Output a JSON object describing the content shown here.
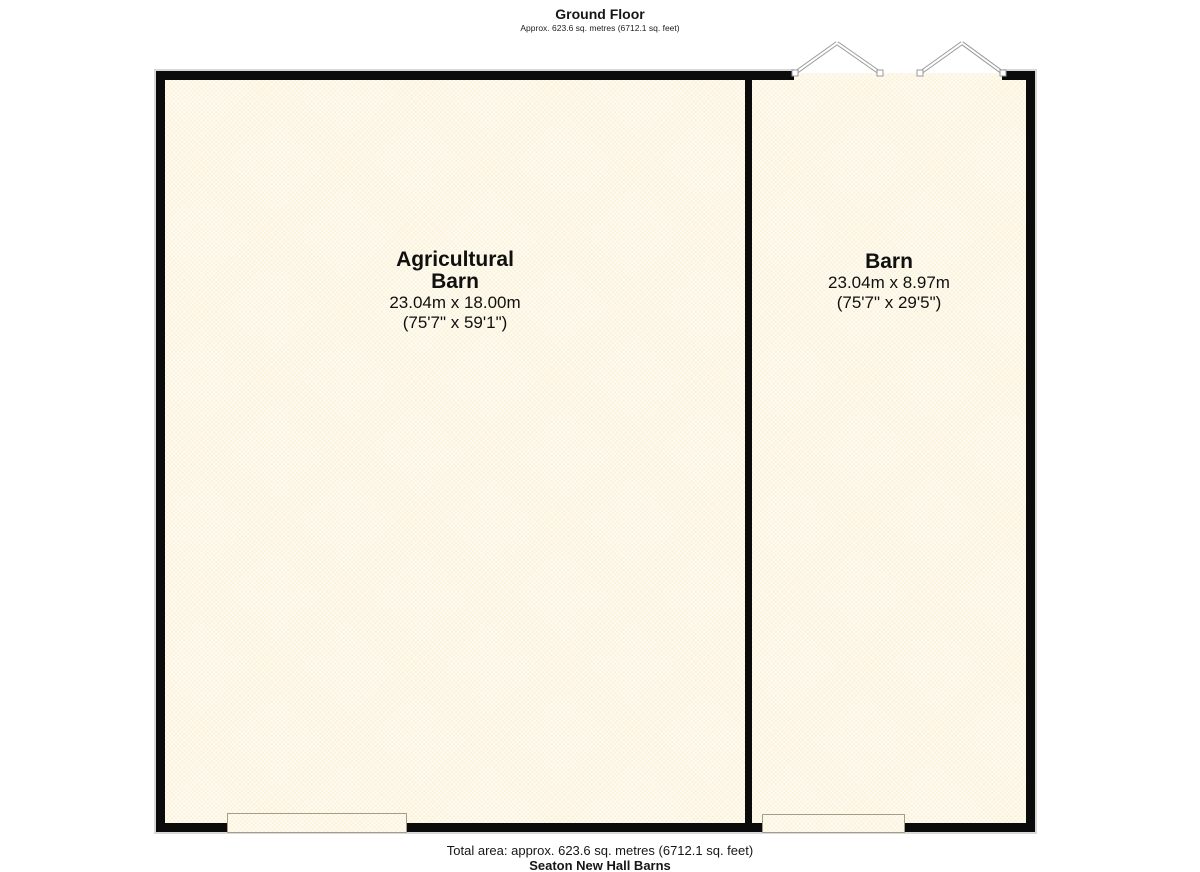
{
  "header": {
    "title": "Ground Floor",
    "subtitle": "Approx. 623.6 sq. metres (6712.1 sq. feet)"
  },
  "rooms": [
    {
      "name": "Agricultural Barn",
      "name_lines": [
        "Agricultural",
        "Barn"
      ],
      "dimensions_metric": "23.04m x 18.00m",
      "dimensions_imperial": "(75'7\" x 59'1\")"
    },
    {
      "name": "Barn",
      "name_lines": [
        "Barn"
      ],
      "dimensions_metric": "23.04m x 8.97m",
      "dimensions_imperial": "(75'7\" x 29'5\")"
    }
  ],
  "footer": {
    "total_area": "Total area: approx. 623.6 sq. metres (6712.1 sq. feet)",
    "property_name": "Seaton New Hall Barns"
  },
  "colors": {
    "wall": "#0b0b0b",
    "room_fill": "#fbf2da",
    "door_line": "#9a9a9a",
    "opening_border": "#a59d86"
  }
}
